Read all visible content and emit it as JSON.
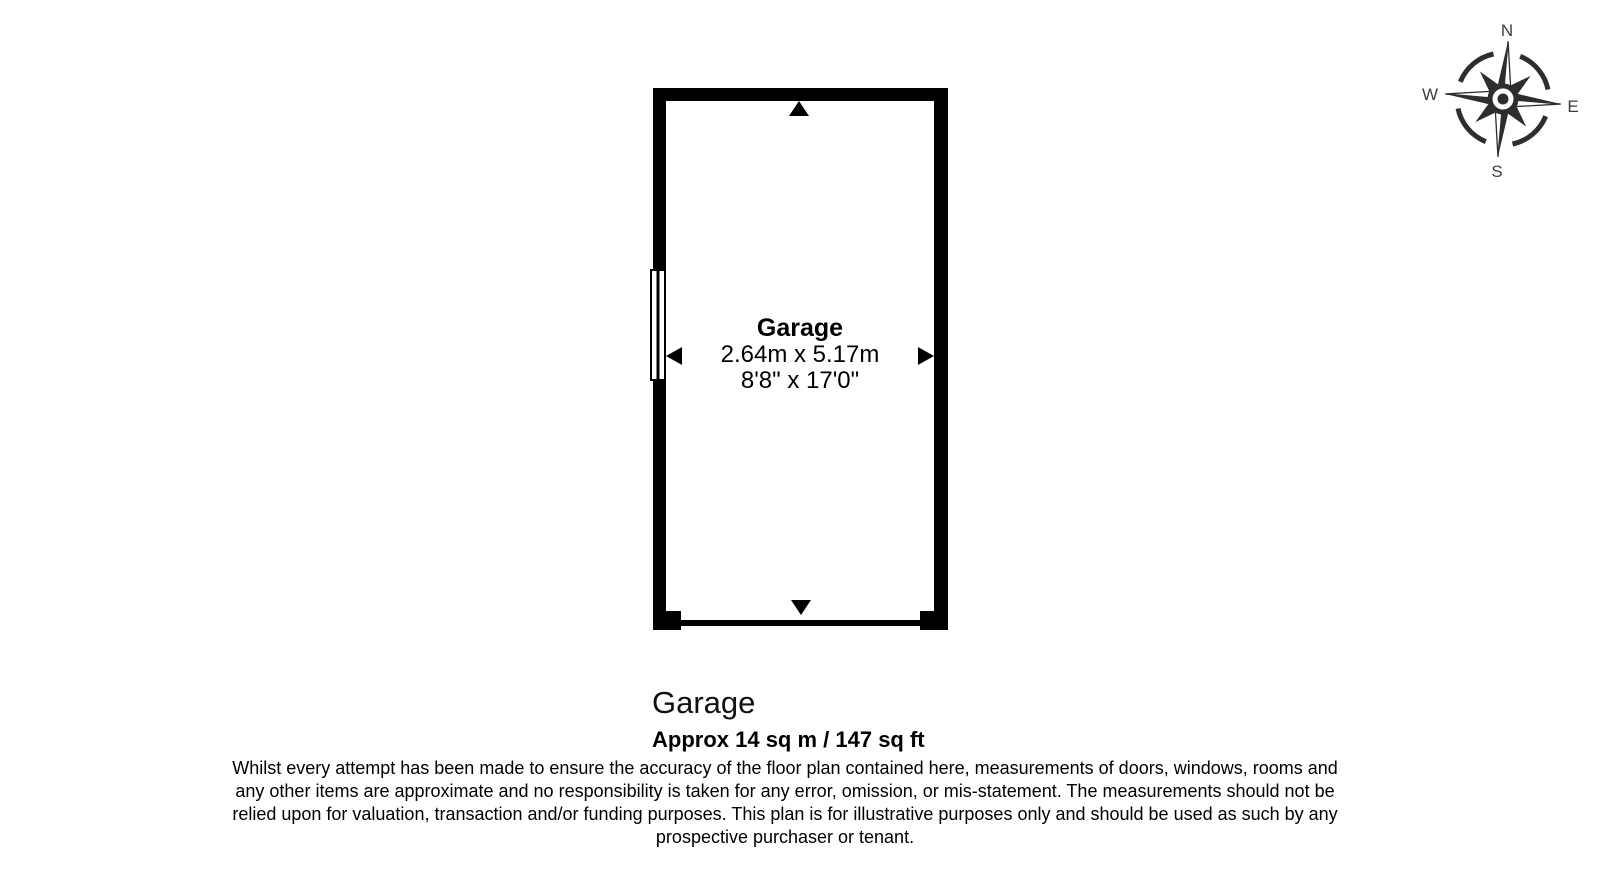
{
  "plan": {
    "wall_color": "#000000",
    "room_label": {
      "name": "Garage",
      "metric": "2.64m x 5.17m",
      "imperial": "8'8\" x 17'0\""
    }
  },
  "footer": {
    "title": "Garage",
    "area": "Approx 14 sq m / 147 sq ft"
  },
  "disclaimer": {
    "lines": [
      "Whilst every attempt has been made to ensure the accuracy of the floor plan contained here, measurements of doors, windows, rooms and",
      "any other items are approximate and no responsibility is taken for any error, omission, or mis-statement. The measurements should not be",
      "relied upon for valuation, transaction and/or funding purposes. This plan is for illustrative purposes only and should be used as such by any",
      "prospective purchaser or tenant."
    ]
  },
  "compass": {
    "color": "#2e2e2e",
    "n": "N",
    "e": "E",
    "s": "S",
    "w": "W"
  }
}
